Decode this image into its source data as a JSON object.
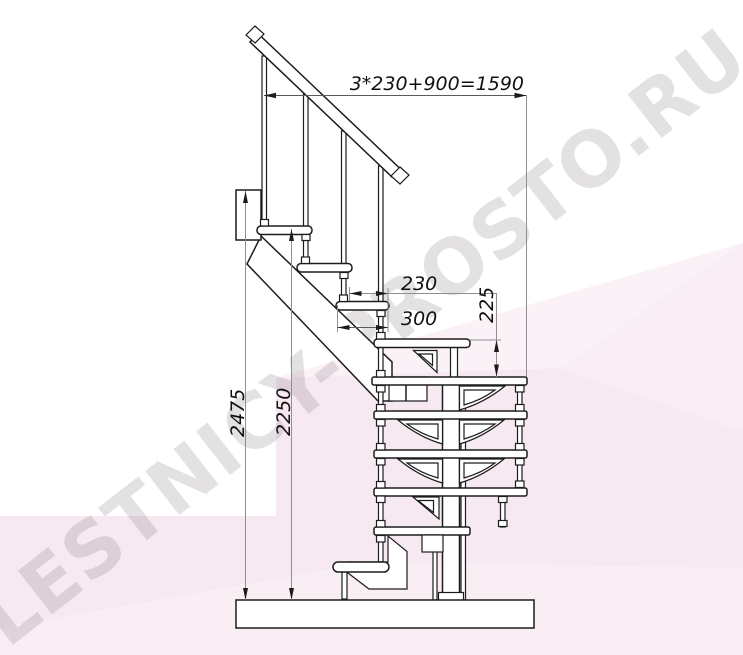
{
  "title": "Staircase side elevation drawing",
  "watermark": {
    "text": "LESTNICY-PROSTO.RU"
  },
  "dimensions": {
    "total_width": "3*230+900=1590",
    "step_run": "230",
    "tread_depth": "300",
    "riser_height": "225",
    "overall_height": "2475",
    "height_to_floor": "2250"
  },
  "structure": {
    "upper_flight_treads": 3,
    "platform_treads": 1,
    "spiral_section_treads": 5,
    "bottom_steps": 1,
    "upper_balusters": 4
  },
  "colors": {
    "line": "#1c1c1c",
    "dimension_line": "#8f8f8f",
    "background_pink": "#f7e9f1",
    "background_pink_light": "#fbf2f7",
    "watermark_gray": "#dcd7da",
    "paper_white": "#ffffff"
  }
}
